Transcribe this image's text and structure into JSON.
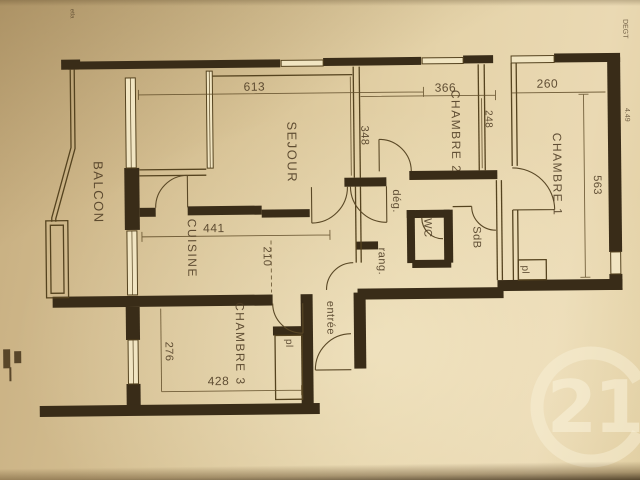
{
  "document_type": "apartment floor plan photo",
  "colors": {
    "paper": "#e0cda2",
    "wall_line": "#3b2e1b",
    "ink": "#4e3c24",
    "watermark": "#f6eed4"
  },
  "rooms": {
    "balcon": "BALCON",
    "sejour": "SEJOUR",
    "cuisine": "CUISINE",
    "chambre1": "CHAMBRE 1",
    "chambre2": "CHAMBRE 2",
    "chambre3": "CHAMBRE 3",
    "degagement": "dég.",
    "wc": "WC",
    "sdb": "SdB",
    "rangement": "rang.",
    "entree": "entrée",
    "placard_chambre1": "pl",
    "placard_chambre3": "pl"
  },
  "dims": {
    "sejour_width": "613",
    "chambre2_width": "366",
    "chambre1_width": "260",
    "sejour_depth": "348",
    "duct_depth": "248",
    "chambre1_depth": "563",
    "cuisine_width": "441",
    "cuisine_depth": "210",
    "chambre3_depth": "276",
    "chambre3_width": "428"
  },
  "notes": {
    "top_left": "etla",
    "right_upper": "DEGT",
    "right_lower": "4.49"
  },
  "watermark": "21"
}
